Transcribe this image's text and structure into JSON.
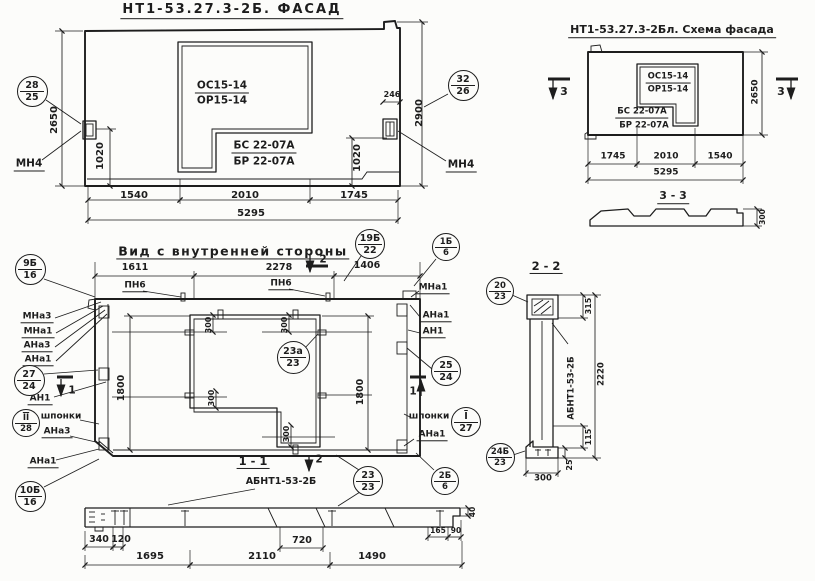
{
  "sheet": {
    "bg": "#fcfcfa",
    "ink": "#1d1d1d"
  },
  "views": {
    "facade": {
      "title": "НТ1-53.27.3-2Б. ФАСАД"
    },
    "facade_schema": {
      "title": "НТ1-53.27.3-2Бл. Схема фасада"
    },
    "inner_side": {
      "title": "Вид с внутренней стороны"
    },
    "section_1_1": {
      "title": "1 - 1",
      "subtitle": "АБНТ1-53-2Б"
    },
    "section_2_2": {
      "title": "2 - 2",
      "side_label": "АБНТ1-53-2Б"
    },
    "section_3_3": {
      "title": "3 - 3"
    }
  },
  "texts": [
    {
      "n": "facade-title",
      "t": "НТ1-53.27.3-2Б. ФАСАД",
      "x": 232,
      "y": 11,
      "s": 13,
      "b": 1,
      "u": 1,
      "ls": 2
    },
    {
      "n": "opening-mark-os",
      "t": "ОС15-14",
      "x": 222,
      "y": 87,
      "s": 10.5,
      "b": 1,
      "u": 1
    },
    {
      "n": "opening-mark-or",
      "t": "ОР15-14",
      "x": 222,
      "y": 101,
      "s": 10.5,
      "b": 1
    },
    {
      "n": "lintel-mark-bs",
      "t": "БС 22-07А",
      "x": 264,
      "y": 147,
      "s": 10.5,
      "b": 1,
      "u": 1
    },
    {
      "n": "lintel-mark-br",
      "t": "БР 22-07А",
      "x": 264,
      "y": 162,
      "s": 10.5,
      "b": 1
    },
    {
      "n": "anchor-label-mn4-left",
      "t": "МН4",
      "x": 29,
      "y": 165,
      "s": 10.5,
      "b": 1,
      "u": 1
    },
    {
      "n": "anchor-label-mn4-right",
      "t": "МН4",
      "x": 461,
      "y": 166,
      "s": 10.5,
      "b": 1,
      "u": 1
    },
    {
      "n": "dim-2650-facade",
      "t": "2650",
      "x": 55,
      "y": 120,
      "s": 10,
      "b": 1,
      "r": -90
    },
    {
      "n": "dim-1020-facade-left",
      "t": "1020",
      "x": 101,
      "y": 156,
      "s": 10,
      "b": 1,
      "r": -90
    },
    {
      "n": "dim-246-facade",
      "t": "246",
      "x": 392,
      "y": 95,
      "s": 8,
      "b": 1
    },
    {
      "n": "dim-2900-facade",
      "t": "2900",
      "x": 420,
      "y": 113,
      "s": 10,
      "b": 1,
      "r": -90
    },
    {
      "n": "dim-1020-facade-right",
      "t": "1020",
      "x": 358,
      "y": 158,
      "s": 10,
      "b": 1,
      "r": -90
    },
    {
      "n": "dim-1540-facade",
      "t": "1540",
      "x": 134,
      "y": 196,
      "s": 10,
      "b": 1
    },
    {
      "n": "dim-2010-facade",
      "t": "2010",
      "x": 245,
      "y": 196,
      "s": 10,
      "b": 1
    },
    {
      "n": "dim-1745-facade",
      "t": "1745",
      "x": 354,
      "y": 196,
      "s": 10,
      "b": 1
    },
    {
      "n": "dim-5295-facade",
      "t": "5295",
      "x": 251,
      "y": 214,
      "s": 10,
      "b": 1
    },
    {
      "n": "schema-title",
      "t": "НТ1-53.27.3-2Бл. Схема фасада",
      "x": 672,
      "y": 31,
      "s": 11,
      "b": 1,
      "u": 1
    },
    {
      "n": "schema-mark-os",
      "t": "ОС15-14",
      "x": 668,
      "y": 78,
      "s": 8.5,
      "b": 1,
      "u": 1
    },
    {
      "n": "schema-mark-or",
      "t": "ОР15-14",
      "x": 668,
      "y": 90,
      "s": 8.5,
      "b": 1
    },
    {
      "n": "schema-mark-bs",
      "t": "БС 22-07А",
      "x": 642,
      "y": 113,
      "s": 8.5,
      "b": 1,
      "u": 1
    },
    {
      "n": "schema-mark-br",
      "t": "БР 22-07А",
      "x": 644,
      "y": 126,
      "s": 8.5,
      "b": 1
    },
    {
      "n": "section3-marker-left",
      "t": "3",
      "x": 564,
      "y": 92,
      "s": 11,
      "b": 1
    },
    {
      "n": "section3-marker-right",
      "t": "3",
      "x": 781,
      "y": 92,
      "s": 11,
      "b": 1
    },
    {
      "n": "dim-1745-schema",
      "t": "1745",
      "x": 613,
      "y": 157,
      "s": 9,
      "b": 1
    },
    {
      "n": "dim-2010-schema",
      "t": "2010",
      "x": 666,
      "y": 157,
      "s": 9,
      "b": 1
    },
    {
      "n": "dim-1540-schema",
      "t": "1540",
      "x": 720,
      "y": 157,
      "s": 9,
      "b": 1
    },
    {
      "n": "dim-5295-schema",
      "t": "5295",
      "x": 666,
      "y": 173,
      "s": 9,
      "b": 1
    },
    {
      "n": "dim-2650-schema",
      "t": "2650",
      "x": 756,
      "y": 92,
      "s": 9,
      "b": 1,
      "r": -90
    },
    {
      "n": "section33-title",
      "t": "3 - 3",
      "x": 673,
      "y": 197,
      "s": 11,
      "b": 1,
      "u": 1
    },
    {
      "n": "dim-300-section33",
      "t": "300",
      "x": 763,
      "y": 217,
      "s": 7.5,
      "b": 1,
      "r": -90
    },
    {
      "n": "inner-title",
      "t": "Вид с внутренней стороны",
      "x": 233,
      "y": 252,
      "s": 12.5,
      "b": 1,
      "u": 1,
      "ls": 1.5
    },
    {
      "n": "dim-1611-inner",
      "t": "1611",
      "x": 135,
      "y": 268,
      "s": 9.5,
      "b": 1
    },
    {
      "n": "dim-2278-inner",
      "t": "2278",
      "x": 279,
      "y": 268,
      "s": 9.5,
      "b": 1
    },
    {
      "n": "dim-1406-inner",
      "t": "1406",
      "x": 367,
      "y": 266,
      "s": 9.5,
      "b": 1
    },
    {
      "n": "section2-marker-top",
      "t": "2",
      "x": 323,
      "y": 260,
      "s": 10.5,
      "b": 1
    },
    {
      "n": "loop-label-pn6-left",
      "t": "ПН6",
      "x": 135,
      "y": 287,
      "s": 9,
      "b": 1,
      "u": 1
    },
    {
      "n": "loop-label-pn6-right",
      "t": "ПН6",
      "x": 281,
      "y": 285,
      "s": 9,
      "b": 1,
      "u": 1
    },
    {
      "n": "label-mna1-top-right",
      "t": "МНа1",
      "x": 433,
      "y": 289,
      "s": 9,
      "b": 1,
      "u": 1
    },
    {
      "n": "label-mna3-left",
      "t": "МНа3",
      "x": 37,
      "y": 318,
      "s": 9,
      "b": 1,
      "u": 1
    },
    {
      "n": "label-mna1-left",
      "t": "МНа1",
      "x": 38,
      "y": 333,
      "s": 9,
      "b": 1,
      "u": 1
    },
    {
      "n": "label-ana3-left",
      "t": "АНа3",
      "x": 37,
      "y": 347,
      "s": 9,
      "b": 1,
      "u": 1
    },
    {
      "n": "label-ana1-left",
      "t": "АНа1",
      "x": 38,
      "y": 361,
      "s": 9,
      "b": 1,
      "u": 1
    },
    {
      "n": "label-an1-left",
      "t": "АН1",
      "x": 40,
      "y": 400,
      "s": 9,
      "b": 1,
      "u": 1
    },
    {
      "n": "section1-marker-left",
      "t": "1",
      "x": 72,
      "y": 391,
      "s": 10.5,
      "b": 1
    },
    {
      "n": "label-shponki-left",
      "t": "шпонки",
      "x": 61,
      "y": 417,
      "s": 9,
      "b": 1
    },
    {
      "n": "label-ana3-left-lower",
      "t": "АНа3",
      "x": 57,
      "y": 433,
      "s": 9,
      "b": 1,
      "u": 1
    },
    {
      "n": "label-ana1-left-lower",
      "t": "АНа1",
      "x": 43,
      "y": 463,
      "s": 9,
      "b": 1,
      "u": 1
    },
    {
      "n": "label-ana1-right",
      "t": "АНа1",
      "x": 436,
      "y": 317,
      "s": 9,
      "b": 1,
      "u": 1
    },
    {
      "n": "label-an1-right",
      "t": "АН1",
      "x": 433,
      "y": 333,
      "s": 9,
      "b": 1,
      "u": 1
    },
    {
      "n": "section1-marker-right",
      "t": "1",
      "x": 413,
      "y": 392,
      "s": 10.5,
      "b": 1
    },
    {
      "n": "label-shponki-right",
      "t": "шпонки",
      "x": 429,
      "y": 417,
      "s": 9,
      "b": 1
    },
    {
      "n": "label-ana1-right-lower",
      "t": "АНа1",
      "x": 432,
      "y": 436,
      "s": 9,
      "b": 1,
      "u": 1
    },
    {
      "n": "dim-300-opening-tl",
      "t": "300",
      "x": 209,
      "y": 325,
      "s": 8,
      "b": 1,
      "r": -90
    },
    {
      "n": "dim-300-opening-tr",
      "t": "300",
      "x": 285,
      "y": 325,
      "s": 8,
      "b": 1,
      "r": -90
    },
    {
      "n": "dim-300-opening-ml",
      "t": "300",
      "x": 212,
      "y": 398,
      "s": 8,
      "b": 1,
      "r": -90
    },
    {
      "n": "dim-300-opening-b",
      "t": "300",
      "x": 287,
      "y": 434,
      "s": 8,
      "b": 1,
      "r": -90
    },
    {
      "n": "dim-1800-inner-left",
      "t": "1800",
      "x": 122,
      "y": 388,
      "s": 9.5,
      "b": 1,
      "r": -90
    },
    {
      "n": "dim-1800-inner-right",
      "t": "1800",
      "x": 361,
      "y": 392,
      "s": 9.5,
      "b": 1,
      "r": -90
    },
    {
      "n": "section11-title",
      "t": "1 - 1",
      "x": 253,
      "y": 462,
      "s": 11.5,
      "b": 1,
      "u": 1
    },
    {
      "n": "section2-marker-bottom",
      "t": "2",
      "x": 319,
      "y": 460,
      "s": 10.5,
      "b": 1
    },
    {
      "n": "section11-subtitle",
      "t": "АБНТ1-53-2Б",
      "x": 281,
      "y": 482,
      "s": 9.5,
      "b": 1
    },
    {
      "n": "dim-720-section11",
      "t": "720",
      "x": 302,
      "y": 541,
      "s": 9.5,
      "b": 1
    },
    {
      "n": "dim-40-section11",
      "t": "40",
      "x": 473,
      "y": 512,
      "s": 7.5,
      "b": 1,
      "r": -90
    },
    {
      "n": "dim-165-section11",
      "t": "165",
      "x": 438,
      "y": 531,
      "s": 7.5,
      "b": 1
    },
    {
      "n": "dim-90-section11",
      "t": "90",
      "x": 456,
      "y": 531,
      "s": 7.5,
      "b": 1
    },
    {
      "n": "dim-340-section11",
      "t": "340",
      "x": 99,
      "y": 540,
      "s": 9.5,
      "b": 1
    },
    {
      "n": "dim-120-section11",
      "t": "120",
      "x": 121,
      "y": 540,
      "s": 9.5,
      "b": 1
    },
    {
      "n": "dim-1695-section11",
      "t": "1695",
      "x": 150,
      "y": 557,
      "s": 10,
      "b": 1
    },
    {
      "n": "dim-2110-section11",
      "t": "2110",
      "x": 262,
      "y": 557,
      "s": 10,
      "b": 1
    },
    {
      "n": "dim-1490-section11",
      "t": "1490",
      "x": 372,
      "y": 557,
      "s": 10,
      "b": 1
    },
    {
      "n": "section22-title",
      "t": "2 - 2",
      "x": 546,
      "y": 267,
      "s": 11.5,
      "b": 1,
      "u": 1
    },
    {
      "n": "dim-315-section22",
      "t": "315",
      "x": 589,
      "y": 306,
      "s": 8,
      "b": 1,
      "r": -90
    },
    {
      "n": "dim-2220-section22",
      "t": "2220",
      "x": 602,
      "y": 374,
      "s": 8.5,
      "b": 1,
      "r": -90
    },
    {
      "n": "section22-side-label",
      "t": "АБНТ1-53-2Б",
      "x": 572,
      "y": 388,
      "s": 8.5,
      "b": 1,
      "r": -90
    },
    {
      "n": "dim-115-section22",
      "t": "115",
      "x": 589,
      "y": 437,
      "s": 8,
      "b": 1,
      "r": -90
    },
    {
      "n": "dim-25-section22",
      "t": "25",
      "x": 570,
      "y": 465,
      "s": 8,
      "b": 1,
      "r": -90
    },
    {
      "n": "dim-300-section22",
      "t": "300",
      "x": 543,
      "y": 479,
      "s": 8.5,
      "b": 1
    }
  ],
  "callouts": [
    {
      "n": "callout-28-25",
      "top": "28",
      "bot": "25",
      "x": 32,
      "y": 91,
      "d": 31
    },
    {
      "n": "callout-32-26",
      "top": "32",
      "bot": "26",
      "x": 463,
      "y": 85,
      "d": 31
    },
    {
      "n": "callout-19b-22",
      "top": "19Б",
      "bot": "22",
      "x": 370,
      "y": 244,
      "d": 30
    },
    {
      "n": "callout-1b-6",
      "top": "1Б",
      "bot": "6",
      "x": 446,
      "y": 247,
      "d": 28
    },
    {
      "n": "callout-9b-16",
      "top": "9Б",
      "bot": "16",
      "x": 30,
      "y": 269,
      "d": 31
    },
    {
      "n": "callout-27-24",
      "top": "27",
      "bot": "24",
      "x": 29,
      "y": 380,
      "d": 31
    },
    {
      "n": "callout-ii-28",
      "top": "II",
      "bot": "28",
      "o": 1,
      "x": 26,
      "y": 423,
      "d": 28
    },
    {
      "n": "callout-10b-16",
      "top": "10Б",
      "bot": "16",
      "x": 30,
      "y": 496,
      "d": 31
    },
    {
      "n": "callout-25-24",
      "top": "25",
      "bot": "24",
      "x": 446,
      "y": 371,
      "d": 30
    },
    {
      "n": "callout-i-27",
      "top": "I",
      "bot": "27",
      "o": 1,
      "x": 466,
      "y": 422,
      "d": 30
    },
    {
      "n": "callout-23a-23",
      "top": "23а",
      "bot": "23",
      "x": 293,
      "y": 357,
      "d": 33
    },
    {
      "n": "callout-23-23",
      "top": "23",
      "bot": "23",
      "x": 368,
      "y": 481,
      "d": 30
    },
    {
      "n": "callout-2b-6",
      "top": "2Б",
      "bot": "6",
      "x": 445,
      "y": 481,
      "d": 28
    },
    {
      "n": "callout-20-23",
      "top": "20",
      "bot": "23",
      "x": 500,
      "y": 291,
      "d": 28
    },
    {
      "n": "callout-24b-23",
      "top": "24Б",
      "bot": "23",
      "x": 500,
      "y": 457,
      "d": 29
    }
  ]
}
